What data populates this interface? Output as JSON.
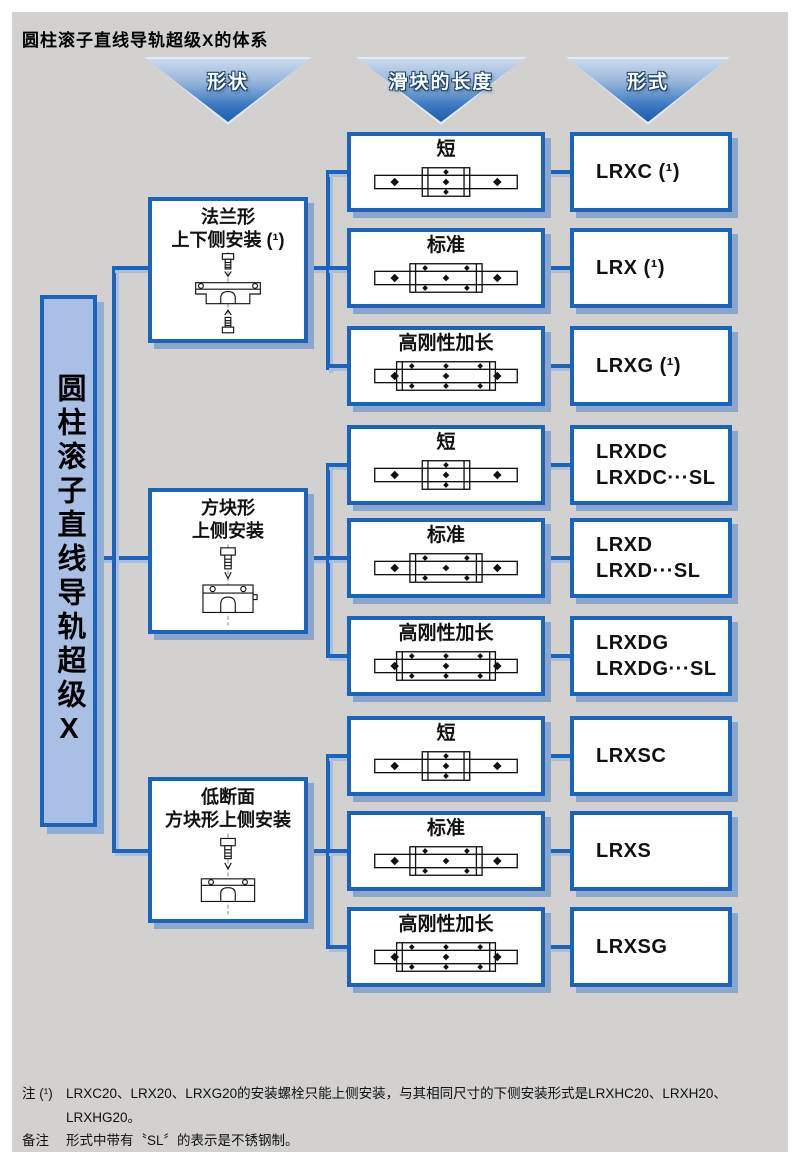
{
  "title": "圆柱滚子直线导轨超级X的体系",
  "colors": {
    "background": "#d2d1d0",
    "line_blue": "#1b64bd",
    "box_shadow": "#8ba6ca",
    "root_fill": "#aabfe4",
    "arrow_gradient_top": "#ccd9ec",
    "arrow_gradient_bottom": "#1d5cab"
  },
  "headers": {
    "shape": "形状",
    "slider_length": "滑块的长度",
    "type": "形式"
  },
  "root": {
    "label": "圆柱滚子直线导轨超级X"
  },
  "shapes": [
    {
      "line1": "法兰形",
      "line2": "上下侧安装 (¹)",
      "icon": "flange-top-bottom-mount"
    },
    {
      "line1": "方块形",
      "line2": "上侧安装",
      "icon": "square-top-mount"
    },
    {
      "line1": "低断面",
      "line2": "方块形上侧安装",
      "icon": "low-profile-top-mount"
    }
  ],
  "rows": [
    {
      "length": "短",
      "variant": "short",
      "model1": "LRXC (¹)"
    },
    {
      "length": "标准",
      "variant": "standard",
      "model1": "LRX (¹)"
    },
    {
      "length": "高刚性加长",
      "variant": "long",
      "model1": "LRXG (¹)"
    },
    {
      "length": "短",
      "variant": "short",
      "model1": "LRXDC",
      "model2": "LRXDC···SL"
    },
    {
      "length": "标准",
      "variant": "standard",
      "model1": "LRXD",
      "model2": "LRXD···SL"
    },
    {
      "length": "高刚性加长",
      "variant": "long",
      "model1": "LRXDG",
      "model2": "LRXDG···SL"
    },
    {
      "length": "短",
      "variant": "short",
      "model1": "LRXSC"
    },
    {
      "length": "标准",
      "variant": "standard",
      "model1": "LRXS"
    },
    {
      "length": "高刚性加长",
      "variant": "long",
      "model1": "LRXSG"
    }
  ],
  "notes": {
    "note1_label": "注 (¹)",
    "note1_text": "LRXC20、LRX20、LRXG20的安装螺栓只能上侧安装，与其相同尺寸的下侧安装形式是LRXHC20、LRXH20、LRXHG20。",
    "note2_label": "备注",
    "note2_text": "形式中带有〝SL〞的表示是不锈钢制。"
  }
}
